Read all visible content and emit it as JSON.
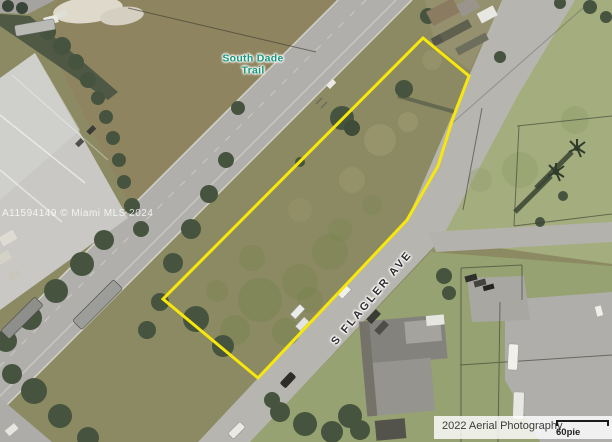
{
  "map": {
    "trail_lines": [
      "South Dade",
      "Trail"
    ],
    "trail_label": "South Dade Trail",
    "street_label": "S FLAGLER AVE",
    "watermark": "A11594149 © Miami MLS 2024"
  },
  "footer": {
    "attribution": "2022 Aerial Photography",
    "scale_label": "60pie"
  },
  "colors": {
    "parcel_outline": "#f7e70a",
    "trail_label": "#17987d",
    "street_label": "#2e2e2e"
  }
}
